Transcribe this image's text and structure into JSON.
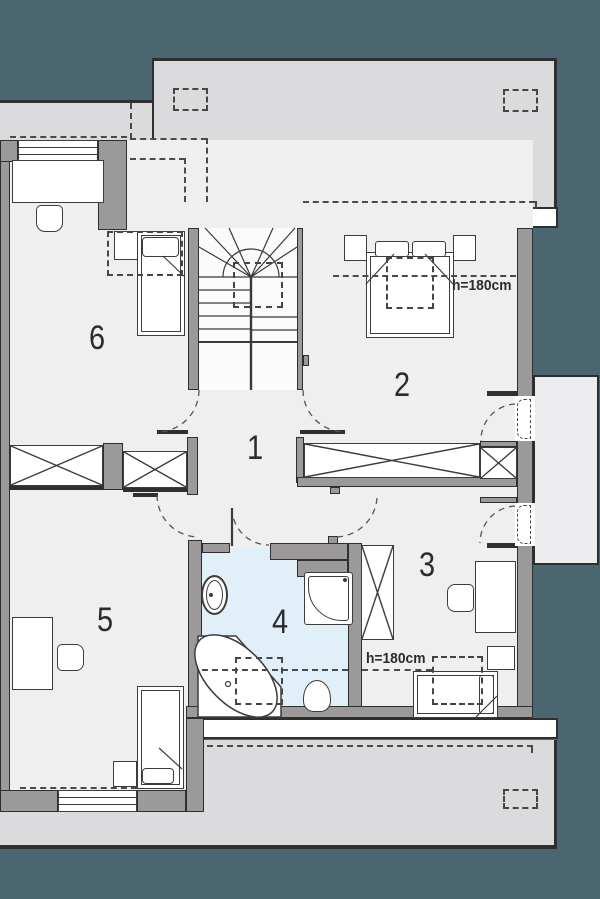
{
  "page": {
    "title": "Floor plan - upper storey"
  },
  "colors": {
    "background_teal": "#4A6670",
    "roof_gray": "#DBDBDD",
    "floor_gray": "#F0EFF0",
    "wall_gray": "#9B999A",
    "bathroom_blue": "#E0EFF8",
    "line_dark": "#2f2f2f",
    "furniture_white": "#FFFFFF"
  },
  "rooms": [
    {
      "id": "room-1",
      "label": "1",
      "type": "hall"
    },
    {
      "id": "room-2",
      "label": "2",
      "type": "bedroom"
    },
    {
      "id": "room-3",
      "label": "3",
      "type": "bedroom"
    },
    {
      "id": "room-4",
      "label": "4",
      "type": "bathroom"
    },
    {
      "id": "room-5",
      "label": "5",
      "type": "bedroom"
    },
    {
      "id": "room-6",
      "label": "6",
      "type": "bedroom"
    }
  ],
  "annotations": {
    "ceiling_height_room2": "h=180cm",
    "ceiling_height_room3": "h=180cm"
  }
}
